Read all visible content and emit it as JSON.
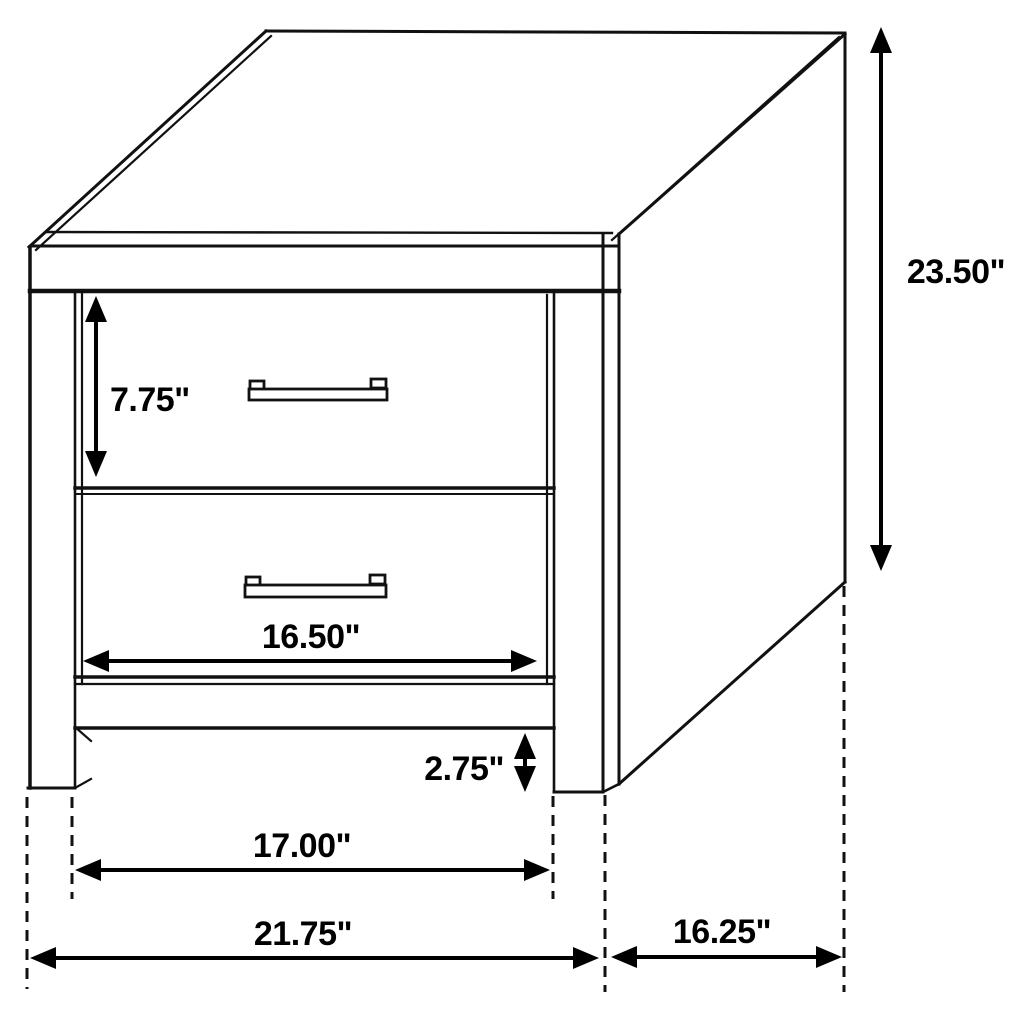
{
  "diagram": {
    "subject": "two-drawer nightstand dimension drawing",
    "style": "black outline isometric line art on white",
    "background_color": "#ffffff",
    "line_color": "#111111",
    "labels": {
      "height": "23.50\"",
      "top_drawer_height": "7.75\"",
      "drawer_width": "16.50\"",
      "foot_height": "2.75\"",
      "inner_leg_span": "17.00\"",
      "overall_width": "21.75\"",
      "depth": "16.25\""
    }
  }
}
